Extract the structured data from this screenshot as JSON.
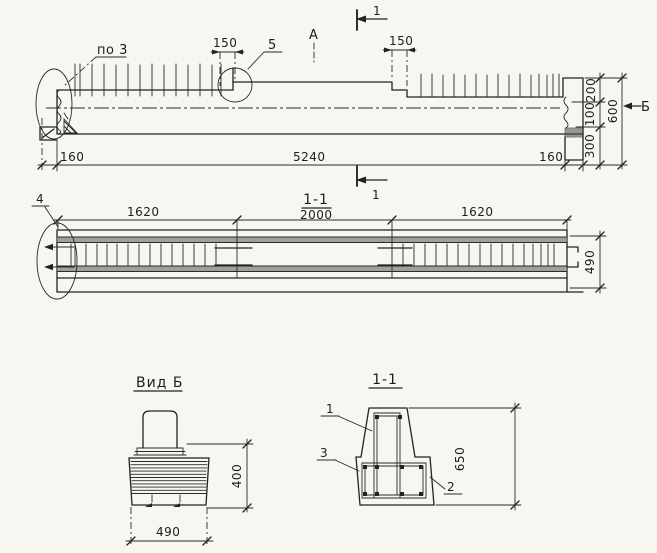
{
  "colors": {
    "ink": "#222222",
    "paper": "#f7f6f1"
  },
  "elevation": {
    "detail_label_top_left": "по 3",
    "detail_label_circle": "5",
    "mark_a": "А",
    "section_mark_top": "1",
    "section_mark_bottom": "1",
    "dim_notch_left": "150",
    "dim_notch_right": "150",
    "dim_left_end": "160",
    "dim_span": "5240",
    "dim_right_end": "160",
    "dim_200": "200",
    "dim_100": "100",
    "dim_600": "600",
    "dim_300": "300",
    "view_arrow_label": "Б"
  },
  "long_section": {
    "title": "1-1",
    "detail_label": "4",
    "dim_left": "1620",
    "dim_middle": "2000",
    "dim_right": "1620",
    "dim_height": "490"
  },
  "view_b": {
    "title": "Вид Б",
    "dim_height": "400",
    "dim_width": "490"
  },
  "cross_section": {
    "title": "1-1",
    "bar_label_1": "1",
    "bar_label_2": "2",
    "bar_label_3": "3",
    "dim_height": "650"
  }
}
